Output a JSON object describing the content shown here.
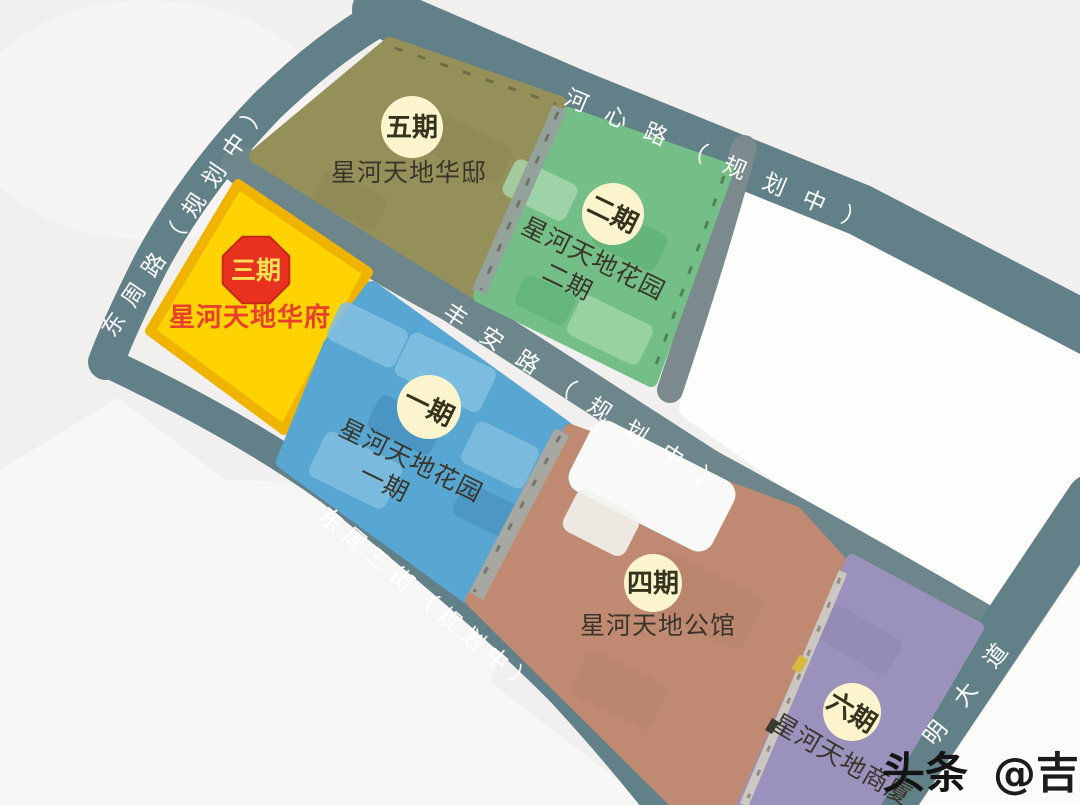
{
  "map_title": "星河天地项目分期规划图",
  "roads": [
    {
      "name": "hexin-road",
      "label": "河心路（规划中）"
    },
    {
      "name": "dongzhou-road",
      "label": "东周路（规划中）"
    },
    {
      "name": "fengan-road",
      "label": "丰安路（规划中）"
    },
    {
      "name": "dongzhou-3rd-street",
      "label": "东周三街（规划中）"
    },
    {
      "name": "ming-avenue",
      "label": "明大道"
    }
  ],
  "zones": [
    {
      "id": "phase5",
      "badge": "五期",
      "caption": "星河天地华邸",
      "color": "#95905a"
    },
    {
      "id": "phase2",
      "badge": "二期",
      "caption_line1": "星河天地花园",
      "caption_line2": "二期",
      "color": "#74bf87"
    },
    {
      "id": "phase3",
      "badge": "三期",
      "caption": "星河天地华府",
      "color": "#ffd201",
      "badge_color": "#e8321f"
    },
    {
      "id": "phase1",
      "badge": "一期",
      "caption_line1": "星河天地花园",
      "caption_line2": "一期",
      "color": "#58a7d3"
    },
    {
      "id": "phase4",
      "badge": "四期",
      "caption": "星河天地公馆",
      "color": "#bf8a71"
    },
    {
      "id": "phase6",
      "badge": "六期",
      "caption": "星河天地商厦",
      "color": "#9a92bc"
    }
  ],
  "watermark": {
    "prefix": "头条",
    "handle": "@吉屋网"
  },
  "colors": {
    "road": "#628087",
    "road_secondary": "#6d868b",
    "badge_circle": "#fcf4cc",
    "badge_text": "#33331f",
    "phase3_octagon": "#e8321f",
    "phase3_octagon_text": "#ffdf52",
    "phase3_caption_text": "#e8402a",
    "road_label_text": "#ffffff",
    "watermark_text": "#141414",
    "background": "#f1f0ee",
    "parcel_white": "#fdfdfc"
  }
}
